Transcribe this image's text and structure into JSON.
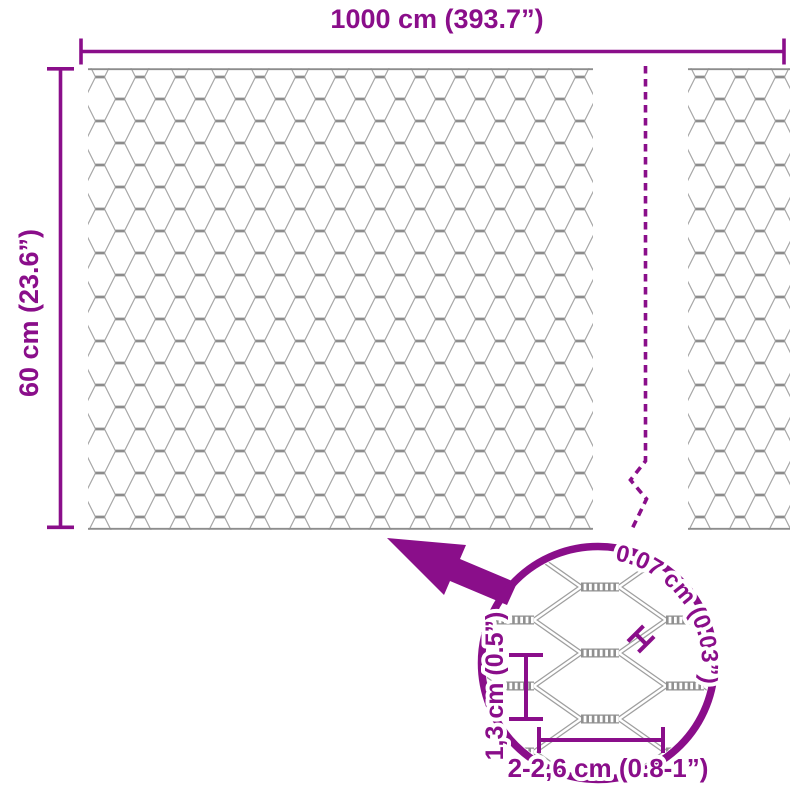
{
  "colors": {
    "accent": "#8a0e8a",
    "wire_gray": "#9f9f9f",
    "wire_gray_dark": "#8d8d8d",
    "background": "#ffffff"
  },
  "product_diagram": {
    "width_label": "1000 cm (393.7”)",
    "height_label": "60 cm (23.6”)",
    "wire_diameter_label": "0.07 cm (0.03”)",
    "cell_height_label": "1,3 cm (0.5”)",
    "cell_width_label": "2-2,6 cm (0.8-1”)"
  }
}
